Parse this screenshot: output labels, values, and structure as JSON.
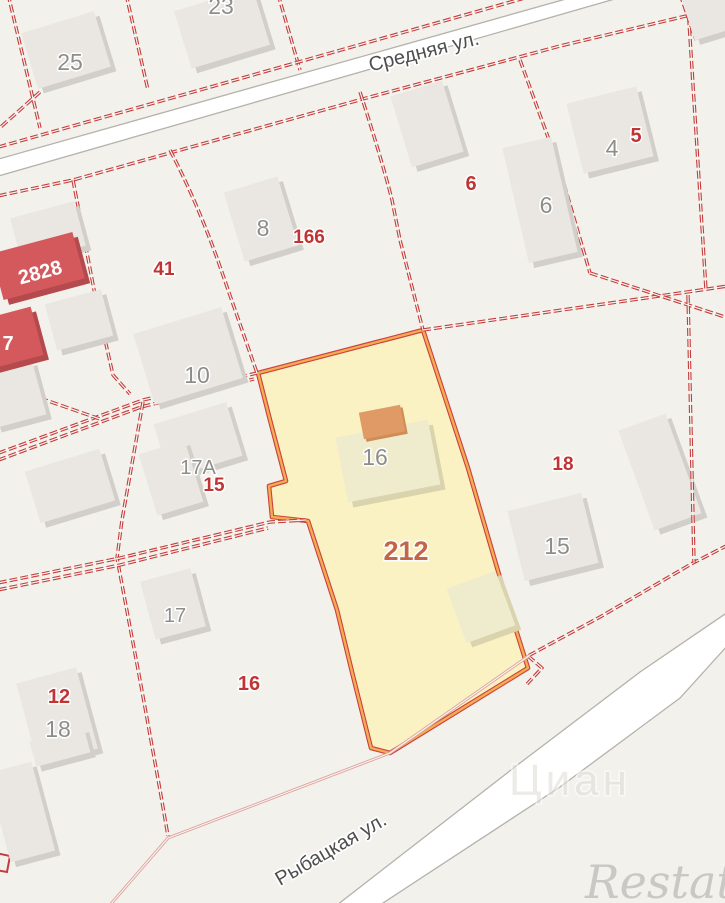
{
  "streets": {
    "top": "Средняя ул.",
    "bottom": "Рыбацкая ул."
  },
  "selected_parcel": {
    "area_number": "212",
    "house_number": "16"
  },
  "labels": {
    "p25": "25",
    "p23": "23",
    "b8": "8",
    "p166": "166",
    "p41": "41",
    "p2828": "2828",
    "p7": "7",
    "b10": "10",
    "b17a": "17А",
    "p15": "15",
    "b17": "17",
    "p16": "16",
    "p12": "12",
    "b18": "18",
    "b4": "4",
    "p5": "5",
    "b6": "6",
    "p6": "6",
    "p18": "18",
    "b15": "15"
  },
  "watermarks": {
    "cian": "Циан",
    "restate": "Restate"
  },
  "colors": {
    "boundary_red": "#c43c3c",
    "selected_fill": "#faf2c3",
    "selected_border_orange": "#f2ac52",
    "selected_border_red": "#cd4040",
    "building_gray": "#eae7e3",
    "building_red": "#d4595c",
    "building_cream": "#efebcd",
    "roof_orange": "#e09a66",
    "label_red": "#c03434",
    "label_gray": "#8d8d8a",
    "street_label": "#4e4e4e"
  }
}
